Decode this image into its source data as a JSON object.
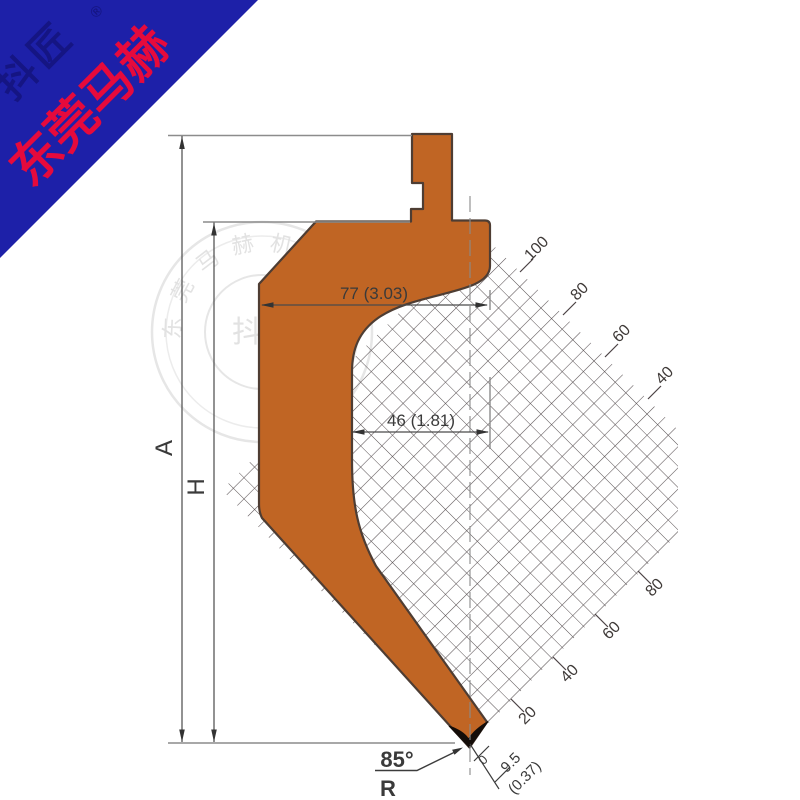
{
  "banner": {
    "company": "东莞马赫",
    "brand": "抖匠",
    "registered": "®",
    "bg_color": "#1d20a8",
    "company_color": "#e60a3c"
  },
  "watermark": {
    "center_text": "抖匠",
    "registered": "®",
    "ring_chars": [
      "东",
      "莞",
      "马",
      "赫",
      "机",
      "械",
      "设",
      "备"
    ]
  },
  "drawing": {
    "punch_color": "#c06524",
    "outline_color": "#4e3d33",
    "grid_line_color": "#4b4244",
    "dimensions": {
      "width_top": "77 (3.03)",
      "width_face": "46 (1.81)",
      "total_height": "A",
      "working_height": "H",
      "tip_angle": "85°",
      "tip_radius_symbol": "R",
      "scale_zero": "0",
      "tip_radius_value": "9.5",
      "tip_radius_inch": "(0.37)"
    },
    "grid_scale": {
      "upper_labels": [
        "100",
        "80",
        "60",
        "40"
      ],
      "lower_labels": [
        "80",
        "60",
        "40",
        "20"
      ]
    }
  }
}
